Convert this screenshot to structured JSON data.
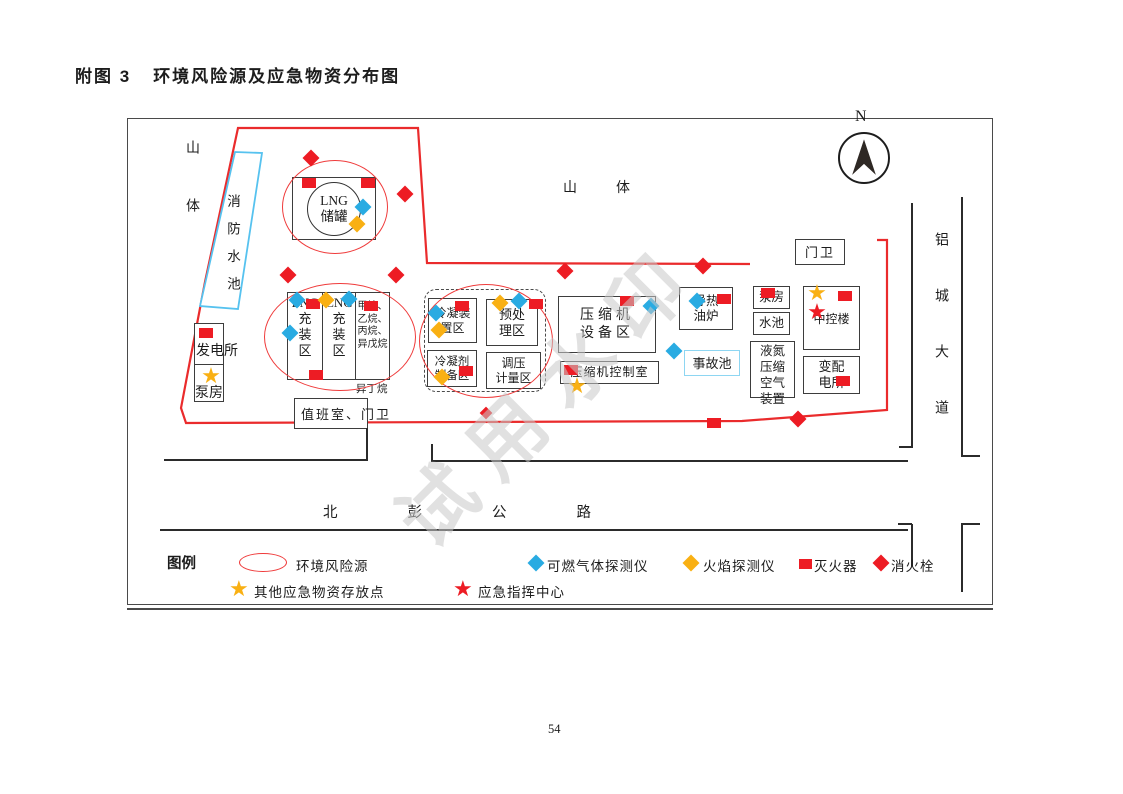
{
  "page": {
    "title_no": "附图 3",
    "title": "环境风险源及应急物资分布图",
    "page_number": "54",
    "watermark": "试用水印"
  },
  "map": {
    "compass_label": "N",
    "terrain": {
      "mountain_left": "山体",
      "mountain_top": "山体"
    },
    "roads": {
      "right_vertical": "铝城大道",
      "bottom_horizontal": "北彭公路"
    },
    "areas": {
      "fire_pool": "消防水池",
      "lng_tank": "LNG\n储罐",
      "power_station": "发电所",
      "pump_house_left": "泵房",
      "lng_filling": "LNG\n充\n装\n区",
      "cng_filling": "CNG\n充\n装\n区",
      "stored_chemicals": "甲烷、\n乙烷、\n丙烷、\n异戊烷",
      "isobutane_note": "异丁烷",
      "duty_room": "值班室、门卫",
      "condenser_unit": "冷凝装\n置区",
      "pretreatment": "预处\n理区",
      "condensant_prep": "冷凝剂\n制备区",
      "pressure_metering": "调压\n计量区",
      "compressor_area": "压缩机\n设备区",
      "compressor_control": "压缩机控制室",
      "oil_furnace": "导热\n油炉",
      "accident_pool": "事故池",
      "gate_north": "门卫",
      "pump_house_right": "泵房",
      "water_pool": "水池",
      "ln_air_unit": "液氮\n压缩\n空气\n装置",
      "control_building": "中控楼",
      "substation": "变配\n电所"
    },
    "legend": {
      "title": "图例",
      "items": [
        {
          "icon": "risk-ellipse",
          "label": "环境风险源"
        },
        {
          "icon": "diamond-blue",
          "label": "可燃气体探测仪"
        },
        {
          "icon": "diamond-yellow",
          "label": "火焰探测仪"
        },
        {
          "icon": "square-red",
          "label": "灭火器"
        },
        {
          "icon": "diamond-red",
          "label": "消火栓"
        },
        {
          "icon": "star-yellow",
          "label": "其他应急物资存放点"
        },
        {
          "icon": "star-red",
          "label": "应急指挥中心"
        }
      ]
    },
    "colors": {
      "risk_red": "#ed1c24",
      "detector_blue": "#29abe2",
      "flame_yellow": "#f9b013",
      "pool_blue": "#56c2ef"
    },
    "markers": [
      {
        "t": "ext",
        "x": 309,
        "y": 183
      },
      {
        "t": "ext",
        "x": 368,
        "y": 183
      },
      {
        "t": "ext",
        "x": 206,
        "y": 333
      },
      {
        "t": "ext",
        "x": 313,
        "y": 304
      },
      {
        "t": "ext",
        "x": 371,
        "y": 306
      },
      {
        "t": "ext",
        "x": 316,
        "y": 375
      },
      {
        "t": "ext",
        "x": 462,
        "y": 306
      },
      {
        "t": "ext",
        "x": 536,
        "y": 304
      },
      {
        "t": "ext",
        "x": 466,
        "y": 371
      },
      {
        "t": "ext",
        "x": 627,
        "y": 301
      },
      {
        "t": "ext",
        "x": 571,
        "y": 370
      },
      {
        "t": "ext",
        "x": 724,
        "y": 299
      },
      {
        "t": "ext",
        "x": 768,
        "y": 293
      },
      {
        "t": "ext",
        "x": 845,
        "y": 296
      },
      {
        "t": "ext",
        "x": 843,
        "y": 381
      },
      {
        "t": "ext",
        "x": 714,
        "y": 423
      },
      {
        "t": "hyd",
        "x": 311,
        "y": 158
      },
      {
        "t": "hyd",
        "x": 405,
        "y": 194
      },
      {
        "t": "hyd",
        "x": 288,
        "y": 275
      },
      {
        "t": "hyd",
        "x": 396,
        "y": 275
      },
      {
        "t": "hyd",
        "x": 565,
        "y": 271
      },
      {
        "t": "hyd",
        "x": 703,
        "y": 266
      },
      {
        "t": "hyd",
        "x": 798,
        "y": 419
      },
      {
        "t": "hyd",
        "x": 486,
        "y": 413,
        "s": 9
      },
      {
        "t": "gas",
        "x": 363,
        "y": 207
      },
      {
        "t": "gas",
        "x": 297,
        "y": 300
      },
      {
        "t": "gas",
        "x": 349,
        "y": 299
      },
      {
        "t": "gas",
        "x": 290,
        "y": 333
      },
      {
        "t": "gas",
        "x": 436,
        "y": 313
      },
      {
        "t": "gas",
        "x": 519,
        "y": 301
      },
      {
        "t": "gas",
        "x": 651,
        "y": 306
      },
      {
        "t": "gas",
        "x": 697,
        "y": 301
      },
      {
        "t": "gas",
        "x": 674,
        "y": 351
      },
      {
        "t": "flame",
        "x": 357,
        "y": 224
      },
      {
        "t": "flame",
        "x": 326,
        "y": 300
      },
      {
        "t": "flame",
        "x": 500,
        "y": 303
      },
      {
        "t": "flame",
        "x": 439,
        "y": 330
      },
      {
        "t": "flame",
        "x": 442,
        "y": 377
      },
      {
        "t": "sup",
        "x": 211,
        "y": 377
      },
      {
        "t": "sup",
        "x": 577,
        "y": 387
      },
      {
        "t": "sup",
        "x": 817,
        "y": 294
      },
      {
        "t": "cmd",
        "x": 817,
        "y": 313
      }
    ]
  }
}
